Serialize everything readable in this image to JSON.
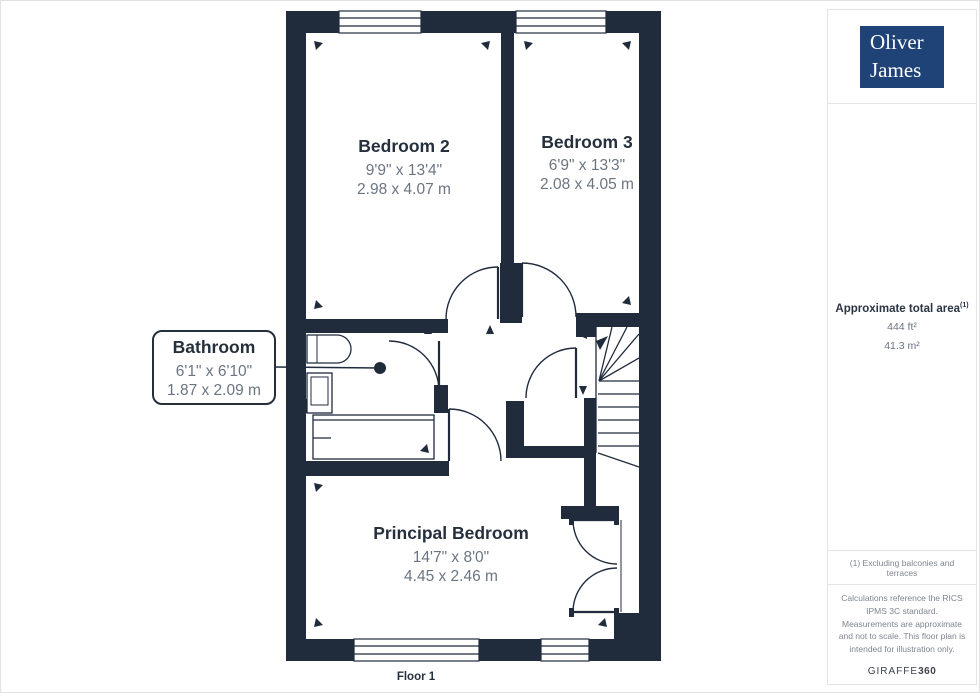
{
  "branding": {
    "logo_line1": "Oliver",
    "logo_line2": "James"
  },
  "plan": {
    "floor_label": "Floor 1",
    "rooms": [
      {
        "name": "Bedroom 2",
        "imperial": "9'9\" x 13'4\"",
        "metric": "2.98 x 4.07 m"
      },
      {
        "name": "Bedroom 3",
        "imperial": "6'9\" x 13'3\"",
        "metric": "2.08 x 4.05 m"
      },
      {
        "name": "Bathroom",
        "imperial": "6'1\" x 6'10\"",
        "metric": "1.87 x 2.09 m"
      },
      {
        "name": "Principal Bedroom",
        "imperial": "14'7\" x 8'0\"",
        "metric": "4.45 x 2.46 m"
      }
    ]
  },
  "sidebar": {
    "area_title": "Approximate total area",
    "area_superscript": "(1)",
    "area_ft": "444 ft²",
    "area_m": "41.3 m²",
    "footnote": "(1) Excluding balconies and terraces",
    "disclaimer": "Calculations reference the RICS IPMS 3C standard. Measurements are approximate and not to scale. This floor plan is intended for illustration only.",
    "watermark_regular": "GIRAFFE",
    "watermark_bold": "360"
  },
  "colors": {
    "wall": "#202b3c",
    "logo_background": "#1f4377",
    "room_text": "#26303d",
    "dimension_text": "#6b7581",
    "panel_border": "#e4e4e4"
  }
}
